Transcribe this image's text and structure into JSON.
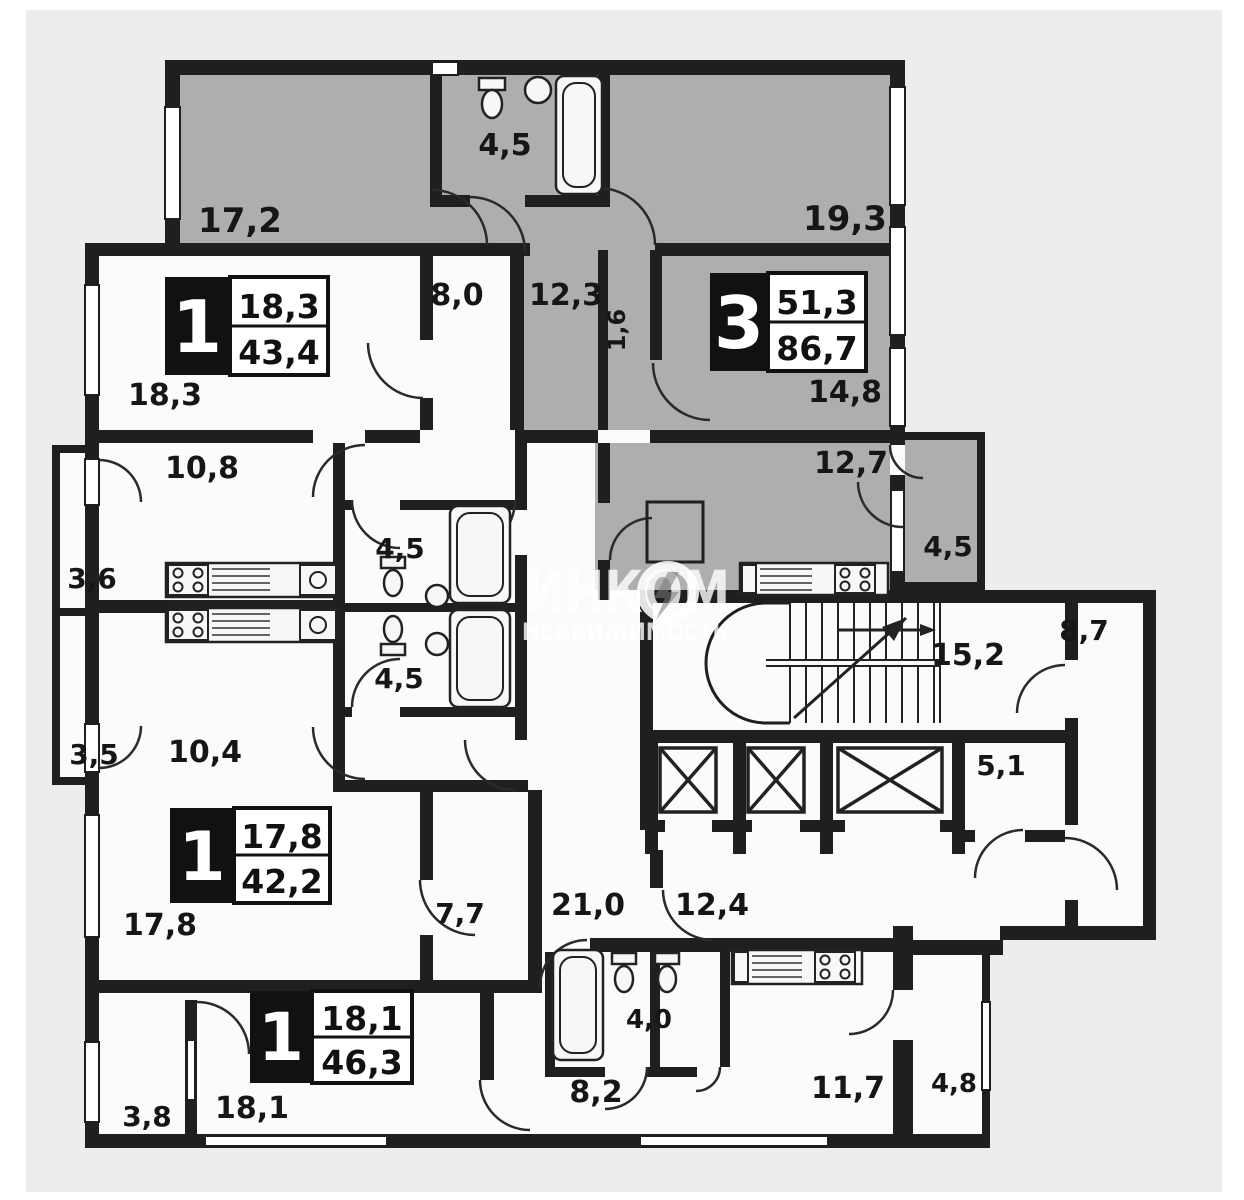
{
  "watermark": {
    "brand": "ИНКОМ",
    "subtitle": "НЕДВИЖИМОСТЬ"
  },
  "apartments": [
    {
      "type": "1",
      "area_living": "18,3",
      "area_total": "43,4"
    },
    {
      "type": "3",
      "area_living": "51,3",
      "area_total": "86,7"
    },
    {
      "type": "1",
      "area_living": "17,8",
      "area_total": "42,2"
    },
    {
      "type": "1",
      "area_living": "18,1",
      "area_total": "46,3"
    }
  ],
  "rooms": [
    {
      "name": "room-top-left",
      "area": "17,2"
    },
    {
      "name": "bathroom-top",
      "area": "4,5"
    },
    {
      "name": "room-top-right",
      "area": "19,3"
    },
    {
      "name": "hall-8-0",
      "area": "8,0"
    },
    {
      "name": "hall-12-3",
      "area": "12,3"
    },
    {
      "name": "niche-1-6",
      "area": "1,6"
    },
    {
      "name": "room-14-8",
      "area": "14,8"
    },
    {
      "name": "room-18-3",
      "area": "18,3"
    },
    {
      "name": "kitchen-10-8",
      "area": "10,8"
    },
    {
      "name": "balcony-3-6",
      "area": "3,6"
    },
    {
      "name": "bathroom-mid-upper",
      "area": "4,5"
    },
    {
      "name": "bathroom-mid-lower",
      "area": "4,5"
    },
    {
      "name": "kitchen-12-7",
      "area": "12,7"
    },
    {
      "name": "balcony-right",
      "area": "4,5"
    },
    {
      "name": "corridor-8-7",
      "area": "8,7"
    },
    {
      "name": "stair-hall-15-2",
      "area": "15,2"
    },
    {
      "name": "balcony-3-5",
      "area": "3,5"
    },
    {
      "name": "kitchen-10-4",
      "area": "10,4"
    },
    {
      "name": "room-5-1",
      "area": "5,1"
    },
    {
      "name": "room-17-8",
      "area": "17,8"
    },
    {
      "name": "hall-7-7",
      "area": "7,7"
    },
    {
      "name": "corridor-21-0",
      "area": "21,0"
    },
    {
      "name": "lobby-12-4",
      "area": "12,4"
    },
    {
      "name": "room-18-1",
      "area": "18,1"
    },
    {
      "name": "balcony-3-8",
      "area": "3,8"
    },
    {
      "name": "wc-4-0",
      "area": "4,0"
    },
    {
      "name": "hall-8-2",
      "area": "8,2"
    },
    {
      "name": "kitchen-11-7",
      "area": "11,7"
    },
    {
      "name": "balcony-4-8",
      "area": "4,8"
    }
  ],
  "colors": {
    "paper": "#ededed",
    "room_fill": "#fbfbfb",
    "apartment3_shade": "#aeaeae",
    "wall": "#1f1f1f",
    "watermark": "#ffffff"
  }
}
